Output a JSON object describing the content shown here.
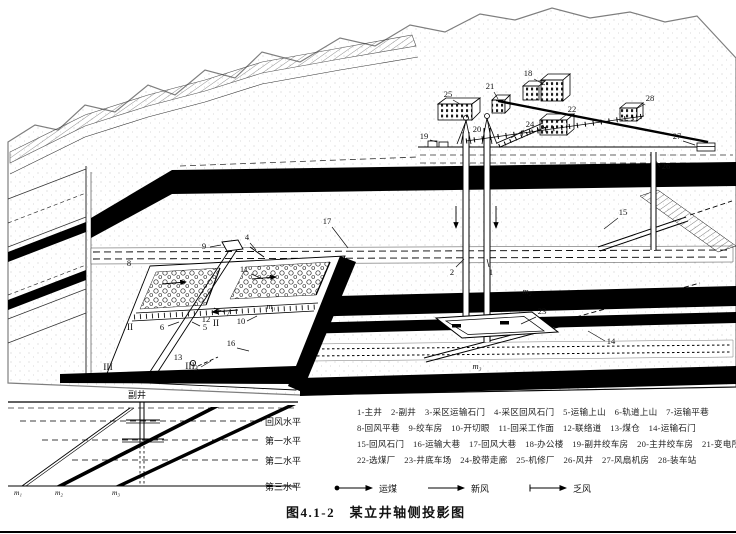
{
  "figure": {
    "caption": "图4.1-2　某立井轴侧投影图"
  },
  "legend": {
    "rows": [
      "1-主井　2-副井　3-采区运输石门　4-采区回风石门　5-运输上山　6-轨道上山　7-运输平巷",
      "8-回风平巷　9-绞车房　10-开切眼　11-回采工作面　12-联络道　13-煤仓　14-运输石门",
      "15-回风石门　16-运输大巷　17-回风大巷　18-办公楼　19-副井绞车房　20-主井绞车房　21-变电所",
      "22-选煤厂　23-井底车场　24-胶带走廊　25-机修厂　26-风井　27-风扇机房　28-装车站"
    ],
    "flows": [
      {
        "label": "运煤",
        "symbol": "dot-tail-arrow"
      },
      {
        "label": "新风",
        "symbol": "plain-arrow"
      },
      {
        "label": "乏风",
        "symbol": "tick-tail-arrow"
      }
    ]
  },
  "inset": {
    "shaft_label": "副井",
    "levels": [
      "回风水平",
      "第一水平",
      "第二水平",
      "第三水平"
    ],
    "seams": [
      "m₁",
      "m₂",
      "m₃"
    ]
  },
  "diagram": {
    "callouts": [
      {
        "t": "1",
        "x": 491,
        "y": 275,
        "l": [
          489,
          267,
          487,
          259
        ]
      },
      {
        "t": "2",
        "x": 452,
        "y": 275,
        "l": [
          456,
          267,
          464,
          259
        ]
      },
      {
        "t": "3",
        "x": 196,
        "y": 371,
        "l": [
          201,
          367,
          211,
          361
        ]
      },
      {
        "t": "4",
        "x": 247,
        "y": 240,
        "l": [
          250,
          243,
          256,
          250
        ]
      },
      {
        "t": "5",
        "x": 205,
        "y": 330,
        "l": [
          200,
          326,
          192,
          322
        ]
      },
      {
        "t": "6",
        "x": 162,
        "y": 330,
        "l": [
          168,
          326,
          179,
          322
        ]
      },
      {
        "t": "7",
        "x": 228,
        "y": 316,
        "l": [
          224,
          312,
          214,
          308
        ]
      },
      {
        "t": "8",
        "x": 129,
        "y": 266
      },
      {
        "t": "9",
        "x": 204,
        "y": 249,
        "l": [
          210,
          247,
          221,
          245
        ]
      },
      {
        "t": "10",
        "x": 241,
        "y": 324,
        "l": [
          247,
          321,
          257,
          316
        ]
      },
      {
        "t": "11",
        "x": 244,
        "y": 272,
        "l": [
          251,
          274,
          263,
          279
        ]
      },
      {
        "t": "12",
        "x": 206,
        "y": 322
      },
      {
        "t": "13",
        "x": 178,
        "y": 360
      },
      {
        "t": "14",
        "x": 611,
        "y": 344,
        "l": [
          605,
          341,
          588,
          331
        ]
      },
      {
        "t": "15",
        "x": 623,
        "y": 215,
        "l": [
          618,
          218,
          604,
          229
        ]
      },
      {
        "t": "16",
        "x": 231,
        "y": 346,
        "l": [
          237,
          348,
          249,
          351
        ]
      },
      {
        "t": "17",
        "x": 327,
        "y": 224,
        "l": [
          332,
          227,
          348,
          248
        ]
      },
      {
        "t": "18",
        "x": 528,
        "y": 76,
        "l": [
          534,
          79,
          545,
          85
        ]
      },
      {
        "t": "19",
        "x": 424,
        "y": 139,
        "l": [
          430,
          140,
          437,
          142
        ]
      },
      {
        "t": "20",
        "x": 477,
        "y": 132
      },
      {
        "t": "21",
        "x": 490,
        "y": 89,
        "l": [
          494,
          92,
          498,
          99
        ]
      },
      {
        "t": "22",
        "x": 572,
        "y": 112,
        "l": [
          566,
          115,
          558,
          121
        ]
      },
      {
        "t": "23",
        "x": 542,
        "y": 314,
        "l": [
          536,
          317,
          521,
          324
        ]
      },
      {
        "t": "24",
        "x": 530,
        "y": 127,
        "l": [
          524,
          130,
          511,
          138
        ]
      },
      {
        "t": "25",
        "x": 448,
        "y": 97,
        "l": [
          453,
          100,
          460,
          104
        ]
      },
      {
        "t": "26",
        "x": 666,
        "y": 169,
        "l": [
          660,
          167,
          656,
          161
        ]
      },
      {
        "t": "27",
        "x": 677,
        "y": 139,
        "l": [
          683,
          141,
          695,
          145
        ]
      },
      {
        "t": "28",
        "x": 650,
        "y": 101,
        "l": [
          645,
          104,
          636,
          109
        ]
      },
      {
        "t": "II",
        "x": 130,
        "y": 330,
        "s": 9.5
      },
      {
        "t": "II",
        "x": 216,
        "y": 326,
        "s": 9.5
      },
      {
        "t": "III",
        "x": 108,
        "y": 370,
        "s": 9.5
      },
      {
        "t": "III",
        "x": 190,
        "y": 369,
        "s": 9.5
      },
      {
        "t": "m₁",
        "x": 271,
        "y": 309,
        "i": true
      },
      {
        "t": "m₂",
        "x": 527,
        "y": 294,
        "i": true
      },
      {
        "t": "m₃",
        "x": 477,
        "y": 369,
        "i": true
      }
    ]
  }
}
